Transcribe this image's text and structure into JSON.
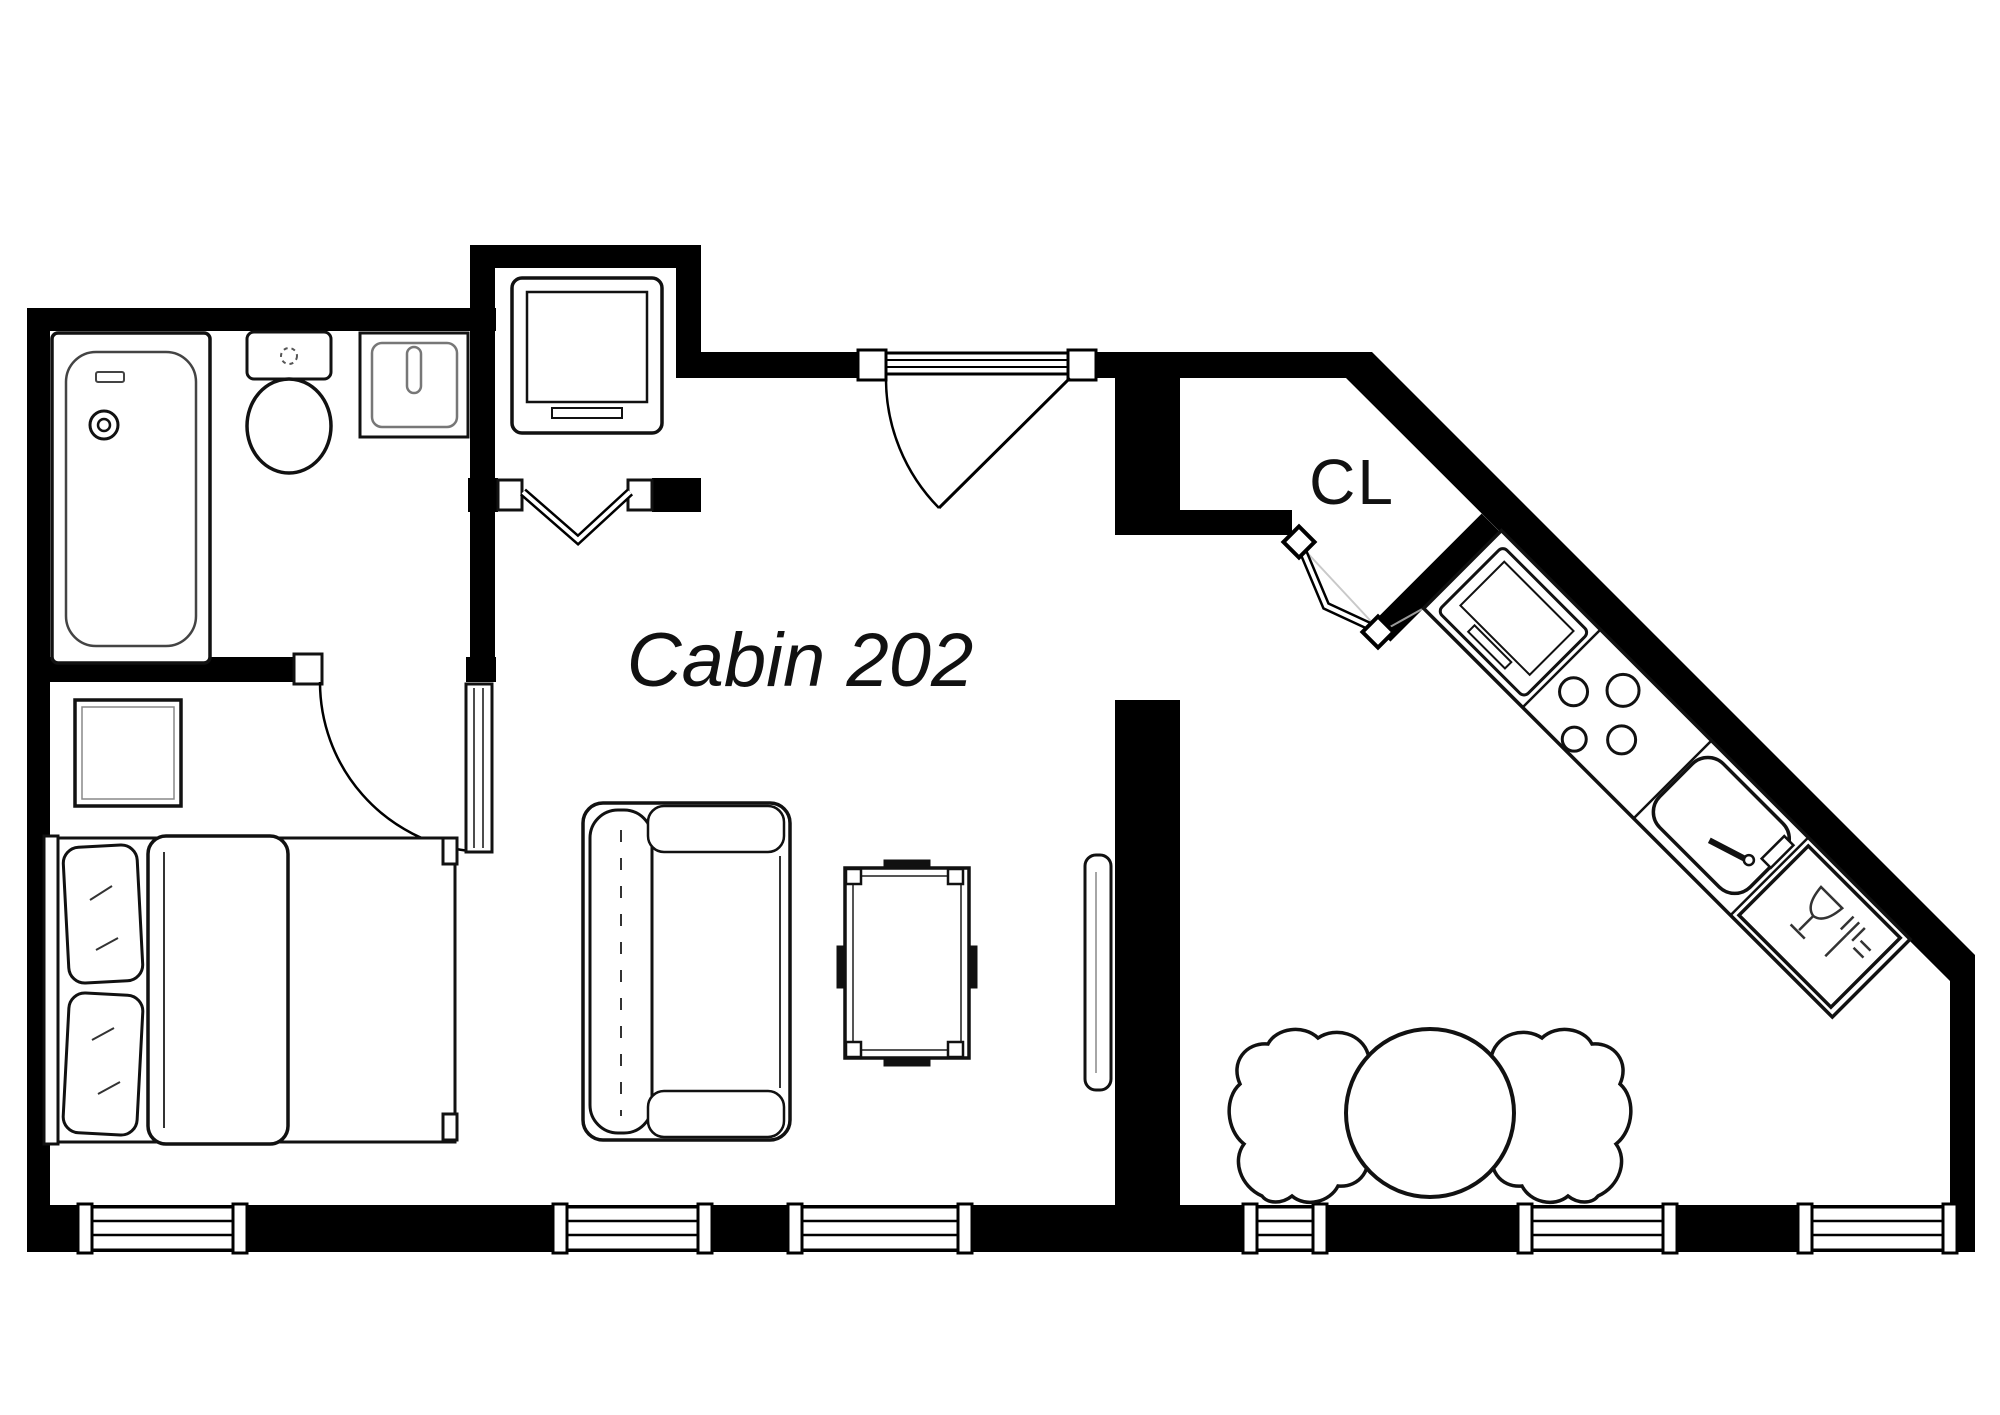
{
  "title": "Cabin 202",
  "labels": {
    "closet": "CL"
  },
  "colors": {
    "wall": "#000000",
    "background": "#ffffff",
    "furniture_line": "#111111",
    "detail_line": "#8a8a8a"
  },
  "rooms": [
    {
      "name": "bathroom",
      "fixtures": [
        "bathtub",
        "toilet",
        "bathroom-sink"
      ]
    },
    {
      "name": "utility-closet",
      "fixtures": [
        "washer-unit"
      ],
      "door": "bifold"
    },
    {
      "name": "closet",
      "label": "CL",
      "door": "bifold"
    },
    {
      "name": "main-cabin",
      "label": "Cabin 202",
      "furniture": [
        "double-bed",
        "nightstand",
        "sofa",
        "trunk-coffee-table",
        "wall-tv"
      ]
    },
    {
      "name": "kitchen",
      "fixtures": [
        "refrigerator",
        "cooktop-4-burner",
        "kitchen-sink",
        "dishwasher"
      ]
    },
    {
      "name": "dining",
      "furniture": [
        "round-dining-table",
        "cloud-chair-left",
        "cloud-chair-right"
      ]
    }
  ],
  "doors": [
    "entry-swing-door",
    "bathroom-swing-door",
    "utility-bifold-door",
    "closet-bifold-door"
  ],
  "windows_count": 6
}
